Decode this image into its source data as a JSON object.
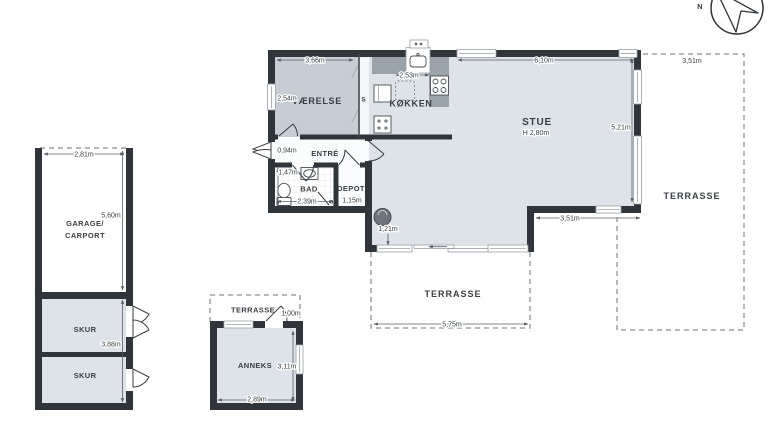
{
  "colors": {
    "wall": "#30353b",
    "floor": "#dde3e9",
    "bedroom_floor": "#c6cdd5",
    "counter": "#9aa2aa",
    "dashed_line": "#8b9198",
    "label_text": "#3a3f45",
    "stove": "#6d747b"
  },
  "compass": {
    "north_label": "N"
  },
  "main_house": {
    "vaerelse": {
      "label": "VÆRELSE",
      "width": "3,66m",
      "depth": "2,54m"
    },
    "closet": {
      "label": "S"
    },
    "koekken": {
      "label": "KØKKEN",
      "width": "2,53m"
    },
    "stue": {
      "label": "STUE",
      "ceiling": "H 2,80m",
      "width": "6,10m",
      "depth": "5,21m",
      "south_wall": "3,51m"
    },
    "entre": {
      "label": "ENTRÉ",
      "width": "0,94m"
    },
    "bad": {
      "label": "BAD",
      "width": "2,39m",
      "depth": "1,47m",
      "shower": "s"
    },
    "depot": {
      "label": "DEPOT",
      "width": "1,15m"
    },
    "stove": {
      "clearance": "1,21m"
    }
  },
  "terraces": {
    "east": {
      "label": "TERRASSE",
      "width": "3,51m"
    },
    "south": {
      "label": "TERRASSE",
      "width": "5,75m"
    },
    "anneks": {
      "label": "TERRASSE",
      "depth": "1,00m"
    }
  },
  "garage_building": {
    "garage": {
      "label_1": "GARAGE/",
      "label_2": "CARPORT",
      "width": "2,81m",
      "depth": "5,60m"
    },
    "skur_top": {
      "label": "SKUR"
    },
    "skur_bottom": {
      "label": "SKUR"
    },
    "skur_depth": "3,88m"
  },
  "anneks": {
    "label": "ANNEKS",
    "width": "2,89m",
    "depth": "3,11m"
  }
}
